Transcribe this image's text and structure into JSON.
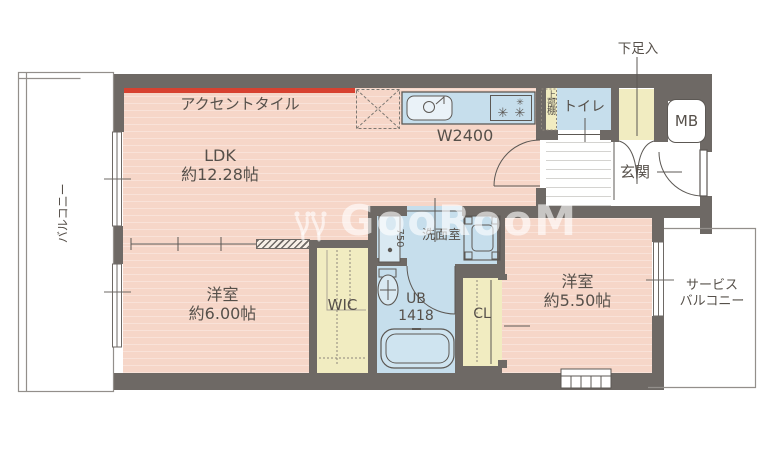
{
  "meta": {
    "type": "apartment-floor-plan",
    "watermark": "GooRooM"
  },
  "colors": {
    "wall": "#6e6965",
    "room_pink": "#f6d6c8",
    "water_blue": "#c6deec",
    "storage_cream": "#f1ecc1",
    "accent_red": "#d74130",
    "label_text": "#56504a"
  },
  "rooms": {
    "ldk": {
      "name": "LDK",
      "size": "約12.28帖",
      "accent_label": "アクセントタイル",
      "kitchen_width": "W2400",
      "upper_shelf": "上部棚"
    },
    "bedroom1": {
      "name": "洋室",
      "size": "約6.00帖"
    },
    "bedroom2": {
      "name": "洋室",
      "size": "約5.50帖"
    },
    "washroom": {
      "name": "洗面室",
      "vanity_width": "750"
    },
    "unit_bath": {
      "name": "UB",
      "size": "1418"
    },
    "toilet": {
      "name": "トイレ"
    },
    "entrance": {
      "name": "玄関",
      "shoe_cabinet": "下足入",
      "meter_box": "MB"
    },
    "storage": {
      "walk_in_closet": "WIC",
      "closet": "CL"
    },
    "balcony": {
      "name": "バルコニー"
    },
    "service_balcony": {
      "line1": "サービス",
      "line2": "バルコニー"
    }
  }
}
